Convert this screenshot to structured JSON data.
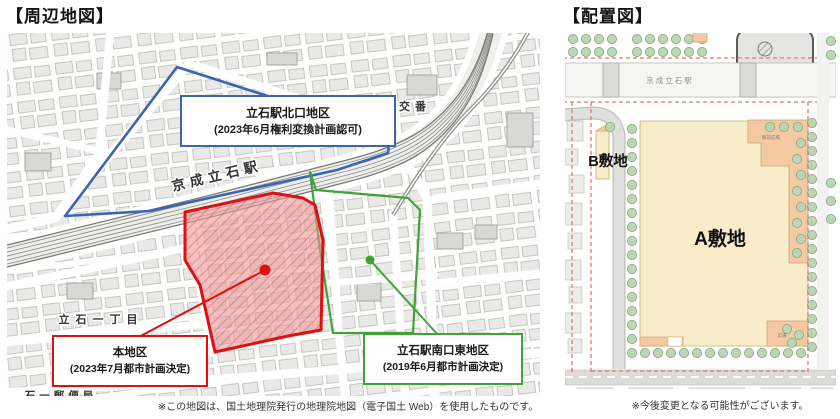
{
  "left": {
    "title": "【周辺地図】",
    "footnote": "※この地図は、国土地理院発行の地理院地図（電子国土 Web）を使用したものです。",
    "map_labels": {
      "station": "京成立石駅",
      "police_box": "立石駅前交番",
      "town": "立石一丁目",
      "post_office": "石一郵便局"
    },
    "districts": [
      {
        "name": "tateishi-north",
        "color": "#3a66b0",
        "line1": "立石駅北口地区",
        "line2": "(2023年6月権利変換計画認可)"
      },
      {
        "name": "main-district",
        "color": "#e01010",
        "line1": "本地区",
        "line2": "(2023年7月都市計画決定)"
      },
      {
        "name": "tateishi-south-east",
        "color": "#44a13a",
        "line1": "立石駅南口東地区",
        "line2": "(2019年6月都市計画決定)"
      }
    ]
  },
  "right": {
    "title": "【配置図】",
    "footnote": "※今後変更となる可能性がございます。",
    "labels": {
      "station": "京成立石駅",
      "site_a": "A敷地",
      "site_b": "B敷地",
      "plaza_top": "駅前広場",
      "plaza_bottom": "広場"
    }
  }
}
